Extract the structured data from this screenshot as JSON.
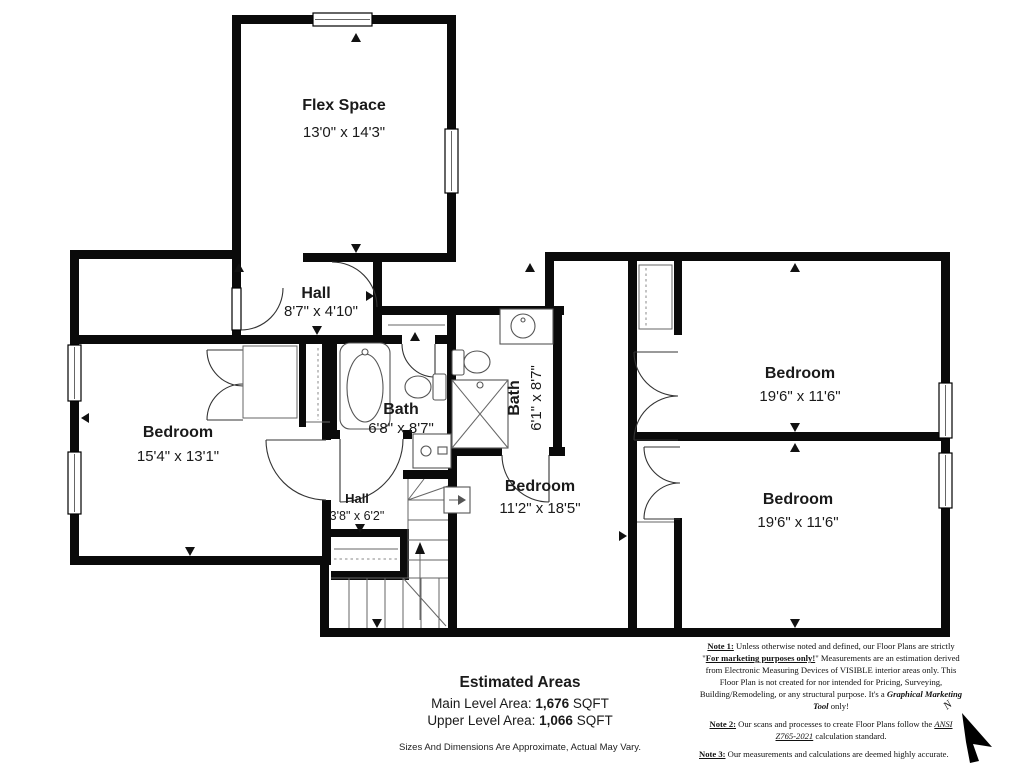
{
  "rooms": [
    {
      "id": "flex-space",
      "label": "Flex Space",
      "dims": "13'0\" x 14'3\""
    },
    {
      "id": "hall-upper",
      "label": "Hall",
      "dims": "8'7\" x 4'10\""
    },
    {
      "id": "bedroom-left",
      "label": "Bedroom",
      "dims": "15'4\" x 13'1\""
    },
    {
      "id": "bath-main",
      "label": "Bath",
      "dims": "6'8\" x 8'7\""
    },
    {
      "id": "bath-small",
      "label": "Bath",
      "dims": "6'1\" x 8'7\""
    },
    {
      "id": "bedroom-middle",
      "label": "Bedroom",
      "dims": "11'2\" x 18'5\""
    },
    {
      "id": "bedroom-top-right",
      "label": "Bedroom",
      "dims": "19'6\" x 11'6\""
    },
    {
      "id": "bedroom-bottom-right",
      "label": "Bedroom",
      "dims": "19'6\" x 11'6\""
    },
    {
      "id": "hall-lower",
      "label": "Hall",
      "dims": "3'8\" x 6'2\""
    }
  ],
  "estimated_areas": {
    "title": "Estimated Areas",
    "main_label": "Main Level Area: ",
    "main_value": "1,676",
    "main_unit": " SQFT",
    "upper_label": "Upper Level Area: ",
    "upper_value": "1,066",
    "upper_unit": "  SQFT",
    "disclaimer": "Sizes And Dimensions Are Approximate, Actual May Vary."
  },
  "notes": {
    "note1": {
      "label": "Note 1:",
      "t1": " Unless otherwise noted and defined, our Floor Plans are strictly \"",
      "em1": "For marketing purposes only!",
      "t2": "\" Measurements are an estimation derived from Electronic Measuring Devices of VISIBLE interior areas only. This Floor Plan is not created for nor intended for Pricing, Surveying, Building/Remodeling, or any structural purpose. It's a ",
      "em2": "Graphical Marketing Tool",
      "t3": " only!"
    },
    "note2": {
      "label": "Note 2:",
      "t1": " Our scans and processes to create Floor Plans follow the ",
      "em1": "ANSI Z765-2021",
      "t2": " calculation standard."
    },
    "note3": {
      "label": "Note 3:",
      "t1": " Our measurements and calculations are deemed highly accurate."
    }
  },
  "compass": {
    "label": "N"
  },
  "colors": {
    "wall": "#0a0a0a",
    "line": "#666666",
    "text": "#1a1a1a"
  }
}
